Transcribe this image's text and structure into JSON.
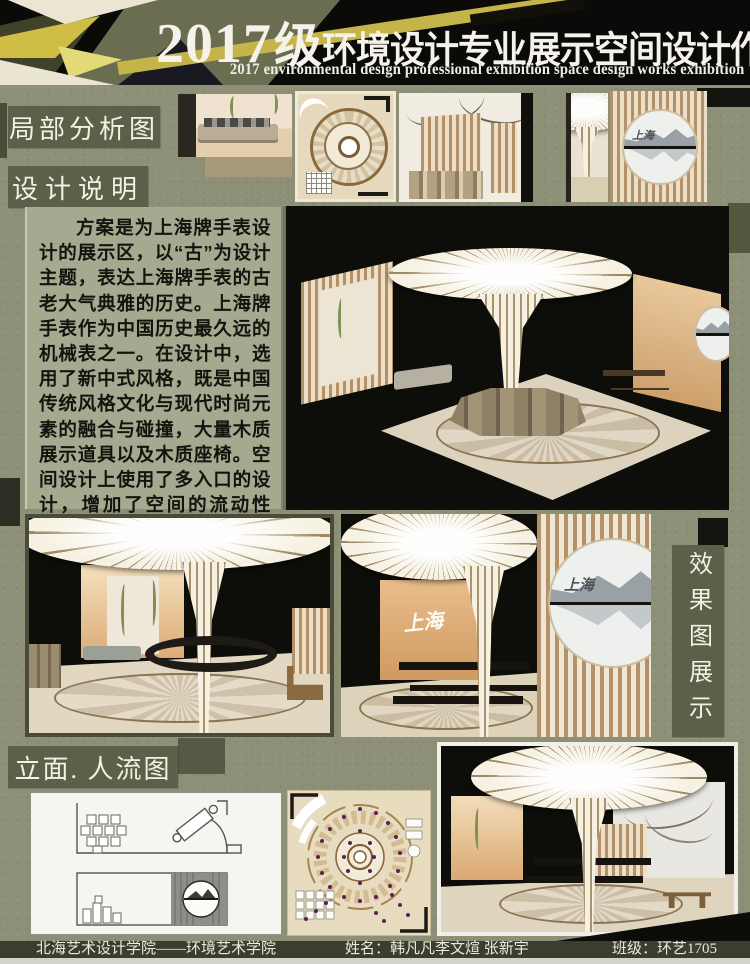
{
  "header": {
    "title_num": "2017",
    "title_grade": "级",
    "title_cn": "环境设计专业展示空间设计作品展",
    "subtitle_en": "2017 environmental design professional exhibition space design works exhibition"
  },
  "labels": {
    "local_analysis": "局部分析图",
    "design_note": "设计说明",
    "effect_display": "效果图展示",
    "elevation_flow": "立面. 人流图"
  },
  "design_note_text": "方案是为上海牌手表设计的展示区，以“古”为设计主题，表达上海牌手表的古老大气典雅的历史。上海牌手表作为中国历史最久远的机械表之一。在设计中，选用了新中式风格，既是中国传统风格文化与现代时尚元素的融合与碰撞，大量木质展示道具以及木质座椅。空间设计上使用了多入口的设计，增加了空间的流动性是。共分了四个功能区.为参观者提供了更好的服务。",
  "renders": {
    "shanghai_calligraphy": "上海"
  },
  "footer": {
    "school": "北海艺术设计学院——环境艺术学院",
    "name_line": "姓名：韩凡凡李文煊 张新宇",
    "class_line": "班级：环艺1705"
  },
  "colors": {
    "background": "#8d9077",
    "label_plate": "#5d6048",
    "note_panel": "#a6a88f",
    "header_bg": "#0a0a08",
    "accent_yellow": "#c9b944",
    "accent_olive": "#6b6d50",
    "flow_dot_purple": "#5c2150"
  }
}
